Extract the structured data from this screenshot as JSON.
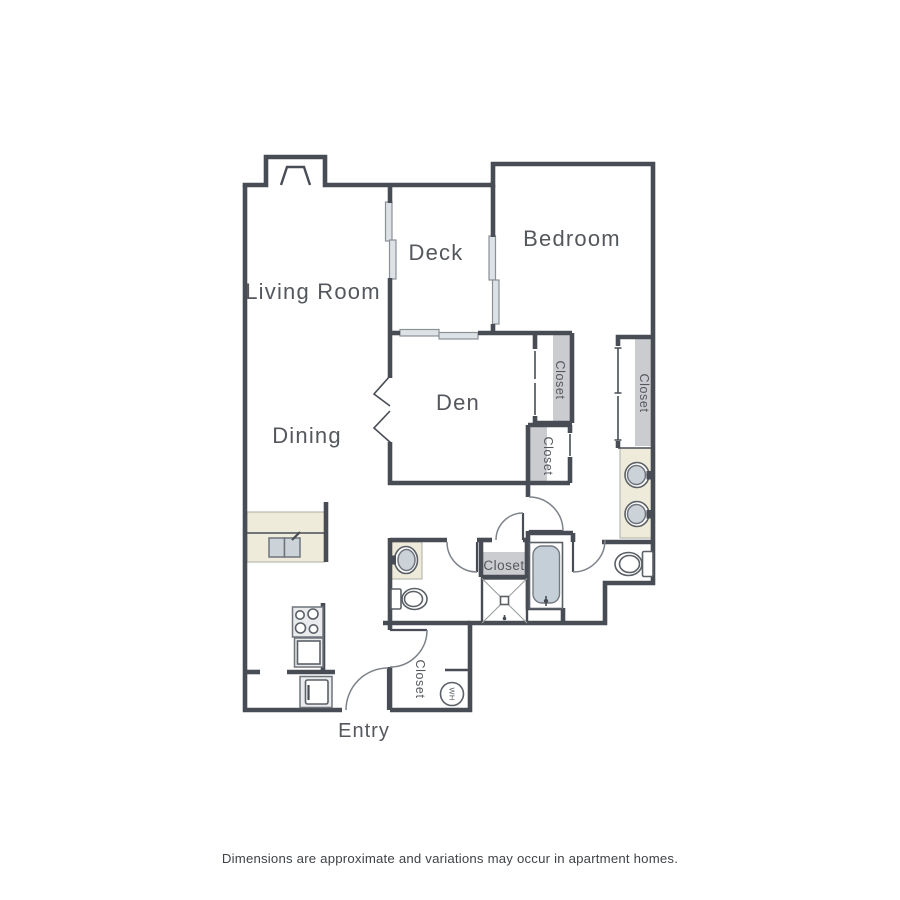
{
  "plan": {
    "rooms": {
      "living_room": "Living Room",
      "dining": "Dining",
      "deck": "Deck",
      "bedroom": "Bedroom",
      "den": "Den",
      "entry": "Entry"
    },
    "labels": {
      "closet": "Closet",
      "water_heater": "WH"
    },
    "disclaimer": "Dimensions are approximate and variations may occur in apartment homes.",
    "colors": {
      "wall": "#484d55",
      "window_fill": "#dde2e6",
      "closet_stripe": "#cbccd0",
      "counter_beige": "#efebda",
      "fixture_fill": "#ccd3d8",
      "tub_fill": "#c5cfd8",
      "arc": "#7e838b",
      "text": "#54575c"
    }
  }
}
